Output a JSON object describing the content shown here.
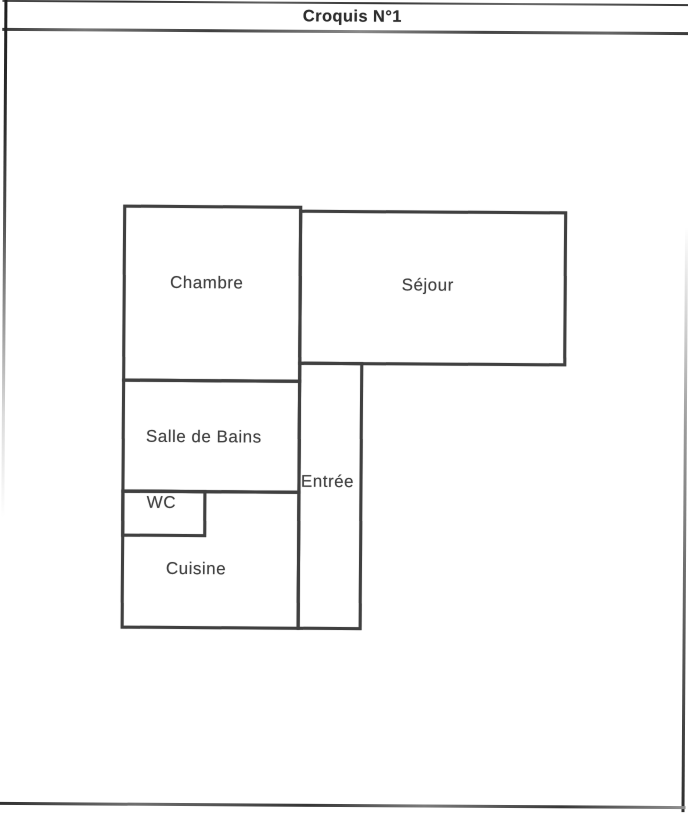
{
  "document": {
    "title": "Croquis N°1"
  },
  "floor_plan": {
    "rooms": {
      "chambre": {
        "label": "Chambre"
      },
      "sejour": {
        "label": "Séjour"
      },
      "salle_de_bains": {
        "label": "Salle de Bains"
      },
      "entree": {
        "label": "Entrée"
      },
      "wc": {
        "label": "WC"
      },
      "cuisine": {
        "label": "Cuisine"
      }
    }
  },
  "colors": {
    "wall_line": "#404040",
    "text": "#434343",
    "page_background": "#ffffff",
    "page_border": "#4a4a4a"
  }
}
